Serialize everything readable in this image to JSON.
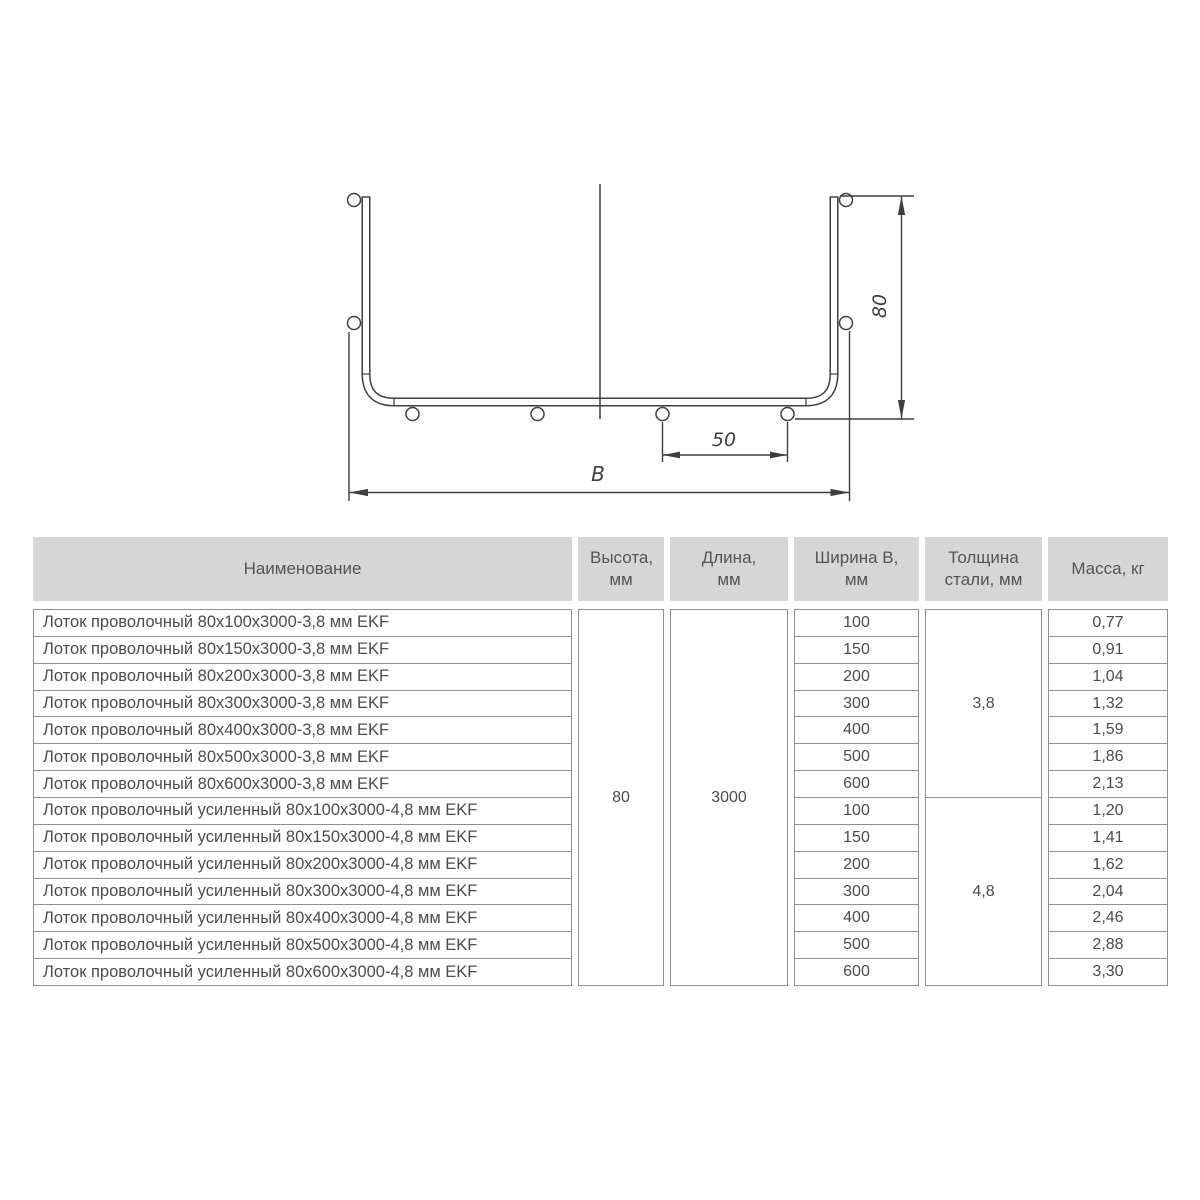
{
  "drawing": {
    "width_label": "B",
    "spacing_label": "50",
    "height_label": "80"
  },
  "table": {
    "headers": {
      "name": "Наименование",
      "height": "Высота, мм",
      "length": "Длина, мм",
      "width": "Ширина В, мм",
      "thickness": "Толщина стали, мм",
      "mass": "Масса, кг"
    },
    "merged": {
      "height": "80",
      "length": "3000",
      "thickness_group1": "3,8",
      "thickness_group2": "4,8"
    },
    "rows": [
      {
        "name": "Лоток проволочный 80х100х3000-3,8 мм EKF",
        "width": "100",
        "mass": "0,77"
      },
      {
        "name": "Лоток проволочный 80х150х3000-3,8 мм EKF",
        "width": "150",
        "mass": "0,91"
      },
      {
        "name": "Лоток проволочный 80х200х3000-3,8 мм EKF",
        "width": "200",
        "mass": "1,04"
      },
      {
        "name": "Лоток проволочный 80х300х3000-3,8 мм EKF",
        "width": "300",
        "mass": "1,32"
      },
      {
        "name": "Лоток проволочный 80х400х3000-3,8 мм EKF",
        "width": "400",
        "mass": "1,59"
      },
      {
        "name": "Лоток проволочный 80х500х3000-3,8 мм EKF",
        "width": "500",
        "mass": "1,86"
      },
      {
        "name": "Лоток проволочный 80х600х3000-3,8 мм EKF",
        "width": "600",
        "mass": "2,13"
      },
      {
        "name": "Лоток проволочный усиленный 80х100х3000-4,8 мм EKF",
        "width": "100",
        "mass": "1,20"
      },
      {
        "name": "Лоток проволочный усиленный 80х150х3000-4,8 мм EKF",
        "width": "150",
        "mass": "1,41"
      },
      {
        "name": "Лоток проволочный усиленный 80х200х3000-4,8 мм EKF",
        "width": "200",
        "mass": "1,62"
      },
      {
        "name": "Лоток проволочный усиленный 80х300х3000-4,8 мм EKF",
        "width": "300",
        "mass": "2,04"
      },
      {
        "name": "Лоток проволочный усиленный 80х400х3000-4,8 мм EKF",
        "width": "400",
        "mass": "2,46"
      },
      {
        "name": "Лоток проволочный усиленный 80х500х3000-4,8 мм EKF",
        "width": "500",
        "mass": "2,88"
      },
      {
        "name": "Лоток проволочный усиленный 80х600х3000-4,8 мм EKF",
        "width": "600",
        "mass": "3,30"
      }
    ]
  },
  "colors": {
    "header_bg": "#d6d6d6",
    "table_border": "#8f8f8f",
    "text": "#4c4c4c",
    "drawing_line": "#3f3f3f"
  }
}
